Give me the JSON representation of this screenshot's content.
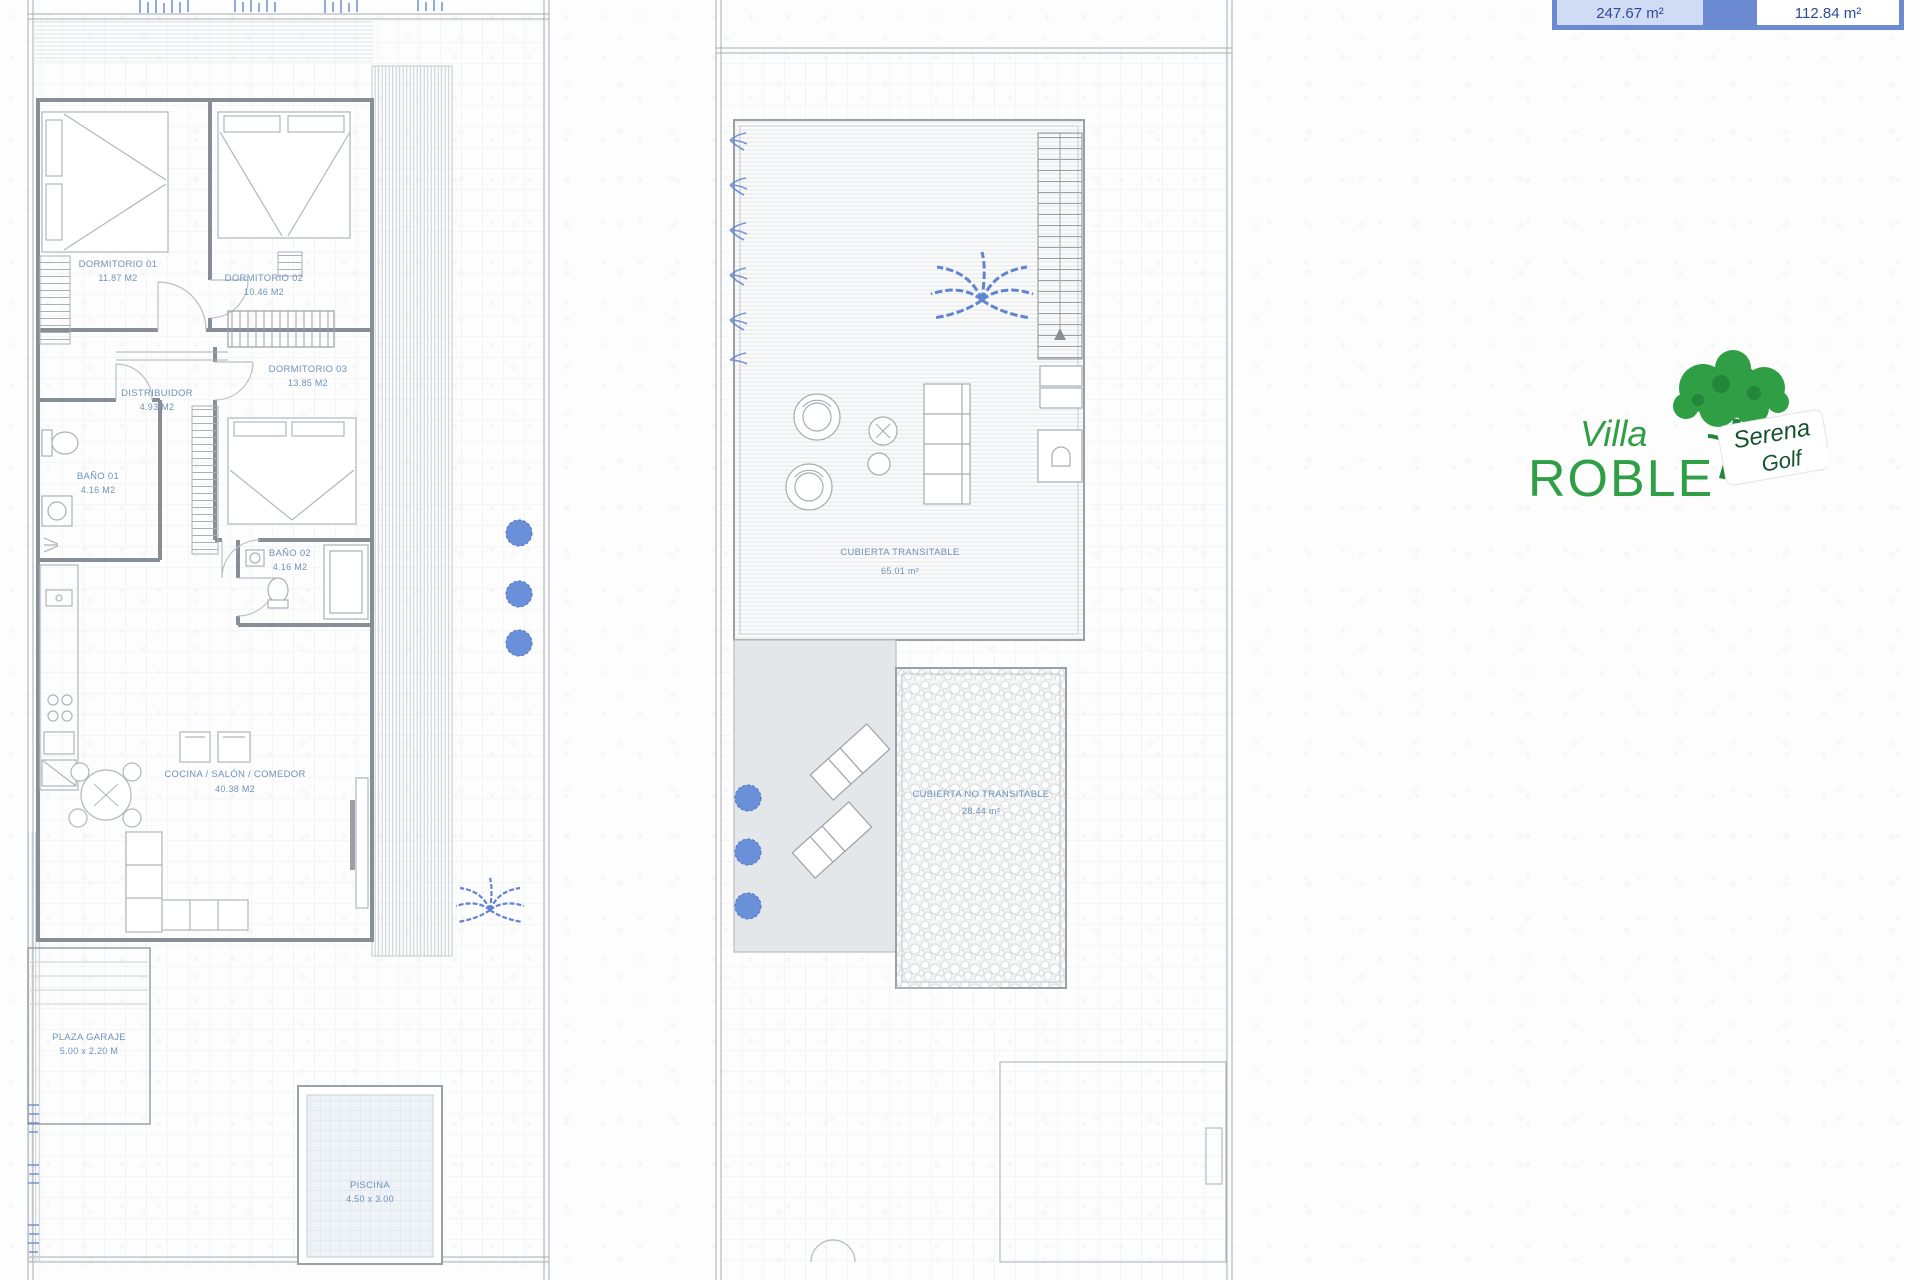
{
  "summary_table": {
    "plot_area": "247.67 m²",
    "built_area": "112.84 m²"
  },
  "ground_floor_plan": {
    "rooms": {
      "dormitorio_01": {
        "name": "DORMITORIO 01",
        "area": "11.87 M2"
      },
      "dormitorio_02": {
        "name": "DORMITORIO 02",
        "area": "10.46 M2"
      },
      "dormitorio_03": {
        "name": "DORMITORIO 03",
        "area": "13.85 M2"
      },
      "distribuidor": {
        "name": "DISTRIBUIDOR",
        "area": "4.93 M2"
      },
      "bano_01": {
        "name": "BAÑO 01",
        "area": "4.16 M2"
      },
      "bano_02": {
        "name": "BAÑO 02",
        "area": "4.16 M2"
      },
      "cocina_salon_comedor": {
        "name": "COCINA / SALÓN / COMEDOR",
        "area": "40.38 M2"
      },
      "plaza_garaje": {
        "name": "PLAZA GARAJE",
        "area": "5.00 x 2.20 M"
      },
      "piscina": {
        "name": "PISCINA",
        "area": "4.50 x 3.00"
      }
    }
  },
  "roof_plan": {
    "areas": {
      "cubierta_transitable": {
        "name": "CUBIERTA TRANSITABLE",
        "area": "65.01 m²"
      },
      "cubierta_no_transitable": {
        "name": "CUBIERTA NO TRANSITABLE",
        "area": "28.44 m²"
      }
    }
  },
  "logo": {
    "title_line1": "Villa",
    "title_line2": "ROBLE",
    "brand_line1": "Serena",
    "brand_line2": "Golf"
  },
  "colors": {
    "vegetation_blue": "#5f85cf",
    "label_blue": "#6e93b8",
    "logo_green": "#2f9e45",
    "table_border_blue": "#6c8ad2",
    "table_cell_fill": "#cfdcf4",
    "table_text_blue": "#2d4a97"
  }
}
